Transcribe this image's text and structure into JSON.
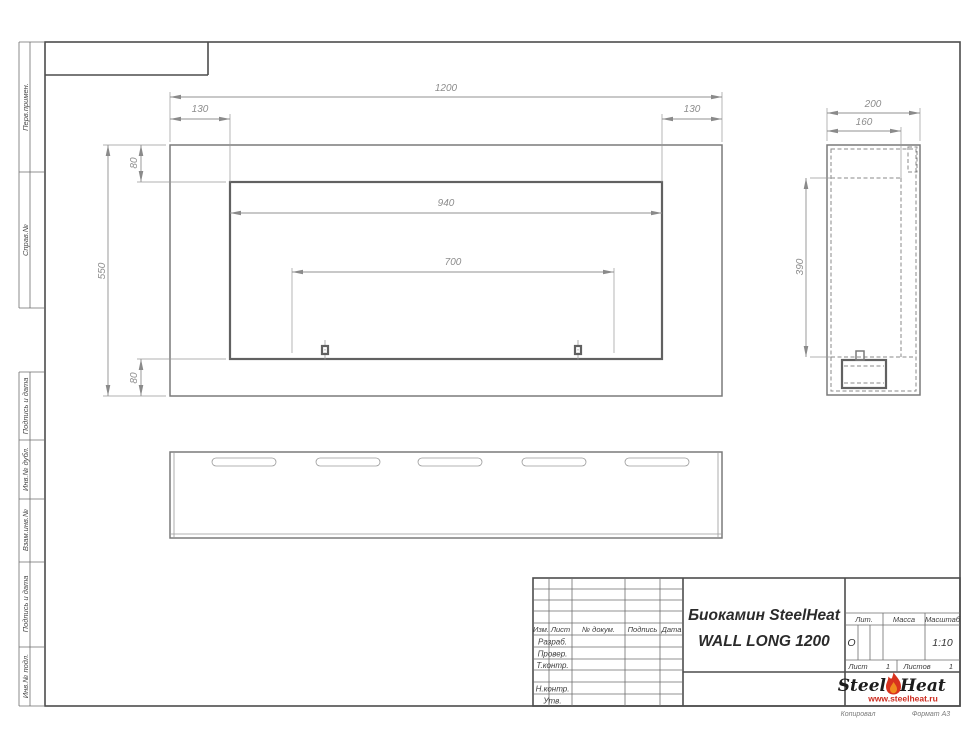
{
  "sheet": {
    "copied_label": "Копировал",
    "format_label": "Формат А3"
  },
  "sidebar": {
    "labels": [
      "Перв.примен.",
      "Справ.№",
      "Подпись и дата",
      "Инв.№ дубл.",
      "Взам.инв.№",
      "Подпись и дата",
      "Инв.№ подл."
    ]
  },
  "title_block": {
    "header_columns": [
      "Изм.",
      "Лист",
      "№ докум.",
      "Подпись",
      "Дата"
    ],
    "row_labels": [
      "Разраб.",
      "Провер.",
      "Т.контр.",
      "Н.контр.",
      "Утв."
    ],
    "title_line1": "Биокамин SteelHeat",
    "title_line2": "WALL LONG 1200",
    "lit_label": "Лит.",
    "lit_value": "О",
    "mass_label": "Масса",
    "scale_label": "Масштаб",
    "scale_value": "1:10",
    "sheet_label": "Лист",
    "sheet_value": "1",
    "sheets_label": "Листов",
    "sheets_value": "1",
    "logo": {
      "part1": "Steel",
      "part2": "Heat",
      "url": "www.steelheat.ru",
      "flame_color": "#d8321e",
      "flame_inner": "#f08a1e",
      "url_color": "#cc2a1e"
    }
  },
  "views": {
    "front": {
      "overall_width": "1200",
      "left_offset": "130",
      "right_offset": "130",
      "overall_height": "550",
      "top_offset": "80",
      "bottom_offset": "80",
      "opening_width": "940",
      "mount_spacing": "700"
    },
    "side": {
      "depth": "200",
      "inner_depth": "160",
      "opening_height": "390"
    }
  }
}
